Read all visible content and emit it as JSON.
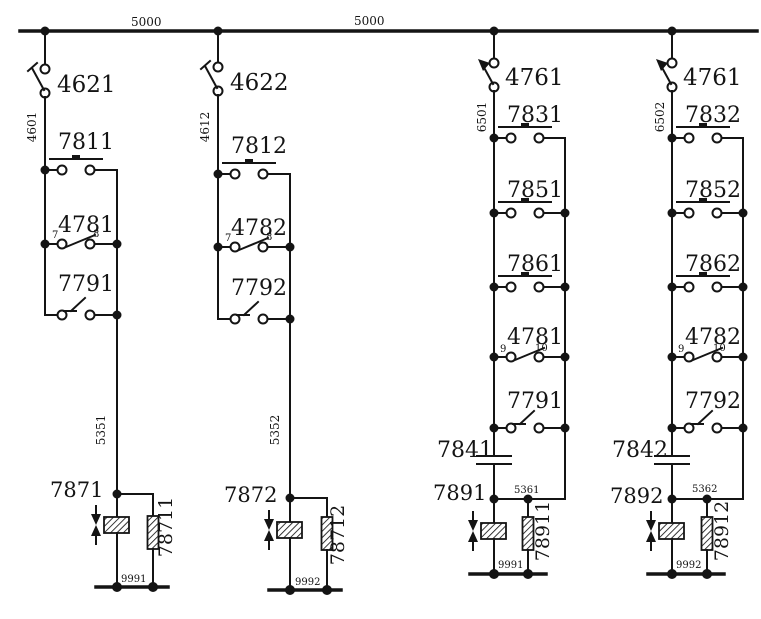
{
  "diagram_title": "relay-ladder-schematic",
  "bus": {
    "labels": [
      "5000",
      "5000"
    ]
  },
  "branches": [
    {
      "switch_label": "4621",
      "feed_wire_label": "4601",
      "rungs": [
        {
          "type": "pushbutton",
          "label": "7811"
        },
        {
          "type": "contact",
          "label": "4781",
          "terminals": [
            "7",
            "8"
          ]
        },
        {
          "type": "relay-contact",
          "label": "7791"
        }
      ],
      "drop_wire_label": "5351",
      "coil_label": "7871",
      "resistor_label": "78711",
      "return_wire_label": "9991"
    },
    {
      "switch_label": "4622",
      "feed_wire_label": "4612",
      "rungs": [
        {
          "type": "pushbutton",
          "label": "7812"
        },
        {
          "type": "contact",
          "label": "4782",
          "terminals": [
            "7",
            "8"
          ]
        },
        {
          "type": "relay-contact",
          "label": "7792"
        }
      ],
      "drop_wire_label": "5352",
      "coil_label": "7872",
      "resistor_label": "78712",
      "return_wire_label": "9992"
    },
    {
      "switch_label": "4761",
      "feed_wire_label": "6501",
      "rungs": [
        {
          "type": "pushbutton",
          "label": "7831"
        },
        {
          "type": "pushbutton",
          "label": "7851"
        },
        {
          "type": "pushbutton",
          "label": "7861"
        },
        {
          "type": "contact",
          "label": "4781",
          "terminals": [
            "9",
            "10"
          ]
        },
        {
          "type": "relay-contact",
          "label": "7791"
        }
      ],
      "capacitor_label": "7841",
      "drop_wire_label": "5361",
      "coil_label": "7891",
      "resistor_label": "78911",
      "return_wire_label": "9991"
    },
    {
      "switch_label": "4761",
      "feed_wire_label": "6502",
      "rungs": [
        {
          "type": "pushbutton",
          "label": "7832"
        },
        {
          "type": "pushbutton",
          "label": "7852"
        },
        {
          "type": "pushbutton",
          "label": "7862"
        },
        {
          "type": "contact",
          "label": "4782",
          "terminals": [
            "9",
            "10"
          ]
        },
        {
          "type": "relay-contact",
          "label": "7792"
        }
      ],
      "capacitor_label": "7842",
      "drop_wire_label": "5362",
      "coil_label": "7892",
      "resistor_label": "78912",
      "return_wire_label": "9992"
    }
  ]
}
